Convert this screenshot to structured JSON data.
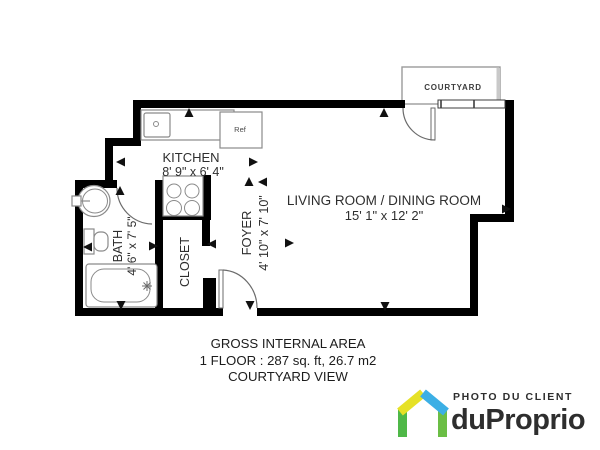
{
  "floor_plan": {
    "rooms": {
      "kitchen": {
        "label": "KITCHEN",
        "dims": "8' 9\" x 6' 4\""
      },
      "living_dining": {
        "label": "LIVING ROOM / DINING ROOM",
        "dims": "15' 1\" x 12' 2\""
      },
      "foyer": {
        "label": "FOYER",
        "dims": "4' 10\" x 7' 10\""
      },
      "bath": {
        "label": "BATH",
        "dims": "4' 6\" x 7' 5\""
      },
      "closet": {
        "label": "CLOSET"
      },
      "courtyard": {
        "label": "COURTYARD"
      }
    },
    "fixtures": {
      "refrigerator_label": "Ref"
    },
    "summary": {
      "line1": "GROSS INTERNAL AREA",
      "line2": "1 FLOOR : 287 sq. ft, 26.7 m2",
      "line3": "COURTYARD VIEW"
    },
    "camera_arrows": [
      {
        "x": 189,
        "y": 113,
        "dir": "up"
      },
      {
        "x": 384,
        "y": 113,
        "dir": "up"
      },
      {
        "x": 506,
        "y": 209,
        "dir": "right"
      },
      {
        "x": 385,
        "y": 306,
        "dir": "down"
      },
      {
        "x": 250,
        "y": 305,
        "dir": "down"
      },
      {
        "x": 121,
        "y": 305,
        "dir": "down"
      },
      {
        "x": 88,
        "y": 247,
        "dir": "left"
      },
      {
        "x": 153,
        "y": 246,
        "dir": "right"
      },
      {
        "x": 212,
        "y": 244,
        "dir": "left"
      },
      {
        "x": 289,
        "y": 243,
        "dir": "right"
      },
      {
        "x": 121,
        "y": 162,
        "dir": "left"
      },
      {
        "x": 253,
        "y": 162,
        "dir": "right"
      },
      {
        "x": 249,
        "y": 182,
        "dir": "up"
      },
      {
        "x": 263,
        "y": 182,
        "dir": "left"
      },
      {
        "x": 120,
        "y": 191,
        "dir": "up"
      }
    ]
  },
  "branding": {
    "tagline": "PHOTO DU CLIENT",
    "brand_name": "duProprio",
    "colors": {
      "green_left": "#4FB848",
      "yellow_roof": "#E6E126",
      "blue_roof": "#3BAFE5",
      "green_right": "#6BBE45",
      "text": "#2B2A29"
    }
  }
}
